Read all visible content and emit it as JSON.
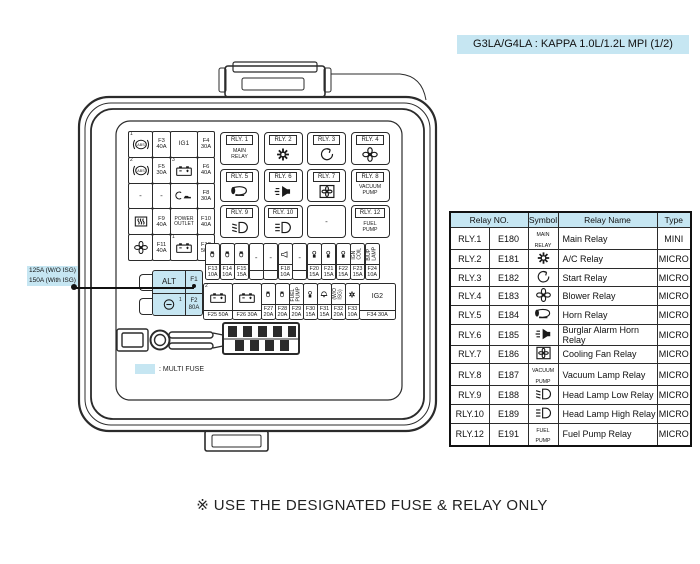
{
  "title": "G3LA/G4LA : KAPPA 1.0L/1.2L MPI (1/2)",
  "footer_note": "※ USE THE DESIGNATED FUSE & RELAY ONLY",
  "colors": {
    "highlight": "#c6e6f2",
    "line": "#2b2b2b"
  },
  "callout": {
    "line1": "125A (W/O ISG)",
    "line2": "150A (With ISG)"
  },
  "legend": {
    "label": ": MULTI FUSE"
  },
  "relay_table": {
    "headers": {
      "relay_no": "Relay NO.",
      "symbol": "Symbol",
      "relay_name": "Relay Name",
      "type": "Type"
    },
    "rows": [
      {
        "relay": "RLY.1",
        "code": "E180",
        "symbol": {
          "kind": "text",
          "value": "MAIN RELAY"
        },
        "name": "Main Relay",
        "type": "MINI"
      },
      {
        "relay": "RLY.2",
        "code": "E181",
        "symbol": {
          "kind": "icon",
          "value": "ac"
        },
        "name": "A/C Relay",
        "type": "MICRO"
      },
      {
        "relay": "RLY.3",
        "code": "E182",
        "symbol": {
          "kind": "icon",
          "value": "start"
        },
        "name": "Start Relay",
        "type": "MICRO"
      },
      {
        "relay": "RLY.4",
        "code": "E183",
        "symbol": {
          "kind": "icon",
          "value": "fan"
        },
        "name": "Blower Relay",
        "type": "MICRO"
      },
      {
        "relay": "RLY.5",
        "code": "E184",
        "symbol": {
          "kind": "icon",
          "value": "horn"
        },
        "name": "Horn Relay",
        "type": "MICRO"
      },
      {
        "relay": "RLY.6",
        "code": "E185",
        "symbol": {
          "kind": "icon",
          "value": "alarmhorn"
        },
        "name": "Burglar Alarm Horn Relay",
        "type": "MICRO"
      },
      {
        "relay": "RLY.7",
        "code": "E186",
        "symbol": {
          "kind": "icon",
          "value": "coolfan"
        },
        "name": "Cooling Fan Relay",
        "type": "MICRO"
      },
      {
        "relay": "RLY.8",
        "code": "E187",
        "symbol": {
          "kind": "text",
          "value": "VACUUM PUMP"
        },
        "name": "Vacuum Lamp Relay",
        "type": "MICRO"
      },
      {
        "relay": "RLY.9",
        "code": "E188",
        "symbol": {
          "kind": "icon",
          "value": "headlow"
        },
        "name": "Head Lamp Low Relay",
        "type": "MICRO"
      },
      {
        "relay": "RLY.10",
        "code": "E189",
        "symbol": {
          "kind": "icon",
          "value": "headhigh"
        },
        "name": "Head Lamp High Relay",
        "type": "MICRO"
      },
      {
        "relay": "RLY.12",
        "code": "E191",
        "symbol": {
          "kind": "text",
          "value": "FUEL PUMP"
        },
        "name": "Fuel Pump Relay",
        "type": "MICRO"
      }
    ]
  },
  "fusebox": {
    "left_grid": [
      [
        {
          "icon": "abs",
          "sup": "1"
        },
        {
          "label": "F3 40A"
        },
        {
          "text": "IG1"
        },
        {
          "label": "F4 30A"
        }
      ],
      [
        {
          "icon": "abs",
          "sup": "2"
        },
        {
          "label": "F5 30A"
        },
        {
          "icon": "battery",
          "sup": "3"
        },
        {
          "label": "F6 40A"
        }
      ],
      [
        {
          "text": "-"
        },
        {
          "text": "-"
        },
        {
          "icon": "deicer"
        },
        {
          "label": "F8 30A"
        }
      ],
      [
        {
          "icon": "heater"
        },
        {
          "label": "F9 40A"
        },
        {
          "text": "POWER OUTLET"
        },
        {
          "label": "F10 40A"
        }
      ],
      [
        {
          "icon": "fan"
        },
        {
          "label": "F11 40A"
        },
        {
          "icon": "battery",
          "sup": "1"
        },
        {
          "label": "F12 50A"
        }
      ]
    ],
    "relays": [
      {
        "label": "RLY. 1",
        "symbol": {
          "kind": "text",
          "value": "MAIN RELAY"
        }
      },
      {
        "label": "RLY. 2",
        "symbol": {
          "kind": "icon",
          "value": "ac"
        }
      },
      {
        "label": "RLY. 3",
        "symbol": {
          "kind": "icon",
          "value": "start"
        }
      },
      {
        "label": "RLY. 4",
        "symbol": {
          "kind": "icon",
          "value": "fan"
        }
      },
      {
        "label": "RLY. 5",
        "symbol": {
          "kind": "icon",
          "value": "horn"
        }
      },
      {
        "label": "RLY. 6",
        "symbol": {
          "kind": "icon",
          "value": "alarmhorn"
        }
      },
      {
        "label": "RLY. 7",
        "symbol": {
          "kind": "icon",
          "value": "coolfan"
        }
      },
      {
        "label": "RLY. 8",
        "symbol": {
          "kind": "text",
          "value": "VACUUM PUMP"
        }
      },
      {
        "label": "RLY. 9",
        "symbol": {
          "kind": "icon",
          "value": "headlow"
        }
      },
      {
        "label": "RLY. 10",
        "symbol": {
          "kind": "icon",
          "value": "headhigh"
        }
      },
      {
        "label": "",
        "symbol": {
          "kind": "dash"
        }
      },
      {
        "label": "RLY. 12",
        "symbol": {
          "kind": "text",
          "value": "FUEL PUMP"
        }
      }
    ],
    "fuse_row1": [
      {
        "icon": "fuse2",
        "label": "F13 10A"
      },
      {
        "icon": "fuse2",
        "label": "F14 10A"
      },
      {
        "icon": "fuse2",
        "label": "F15 15A"
      },
      {
        "text": "-"
      },
      {
        "text": "-"
      },
      {
        "icon": "hornS",
        "label": "F18 10A"
      },
      {
        "text": "-"
      },
      {
        "icon": "coil",
        "label": "F20 15A"
      },
      {
        "icon": "coil",
        "label": "F21 15A"
      },
      {
        "icon": "coil",
        "label": "F22 15A"
      },
      {
        "vtext": "IGN COIL",
        "label": "F23 15A"
      },
      {
        "vtext": "B/UP LAMP",
        "label": "F24 10A"
      }
    ],
    "fuse_row2": [
      {
        "icon": "battery",
        "sup": "2",
        "label": "F25 50A",
        "w": 29,
        "oneline": true
      },
      {
        "icon": "battery",
        "label": "F26 30A",
        "w": 29,
        "oneline": true
      },
      {
        "icon": "fuse2",
        "label": "F27 20A"
      },
      {
        "icon": "fuse2",
        "label": "F28 20A"
      },
      {
        "vtext": "FUEL PUMP",
        "label": "F29 20A"
      },
      {
        "icon": "coil",
        "label": "F30 15A"
      },
      {
        "icon": "bell",
        "label": "F31 15A"
      },
      {
        "vtext": "(W/O ISG)",
        "label": "F32 20A"
      },
      {
        "icon": "gear",
        "label": "F33 10A"
      },
      {
        "text": "IG2",
        "label": "F34 30A",
        "w": 36,
        "oneline": true
      }
    ],
    "alt_block": {
      "r1c1": "ALT",
      "r1c2": "F1",
      "r2c1_icon": "altcirc",
      "r2c1_sup": "1",
      "r2c2": "F2 80A"
    }
  }
}
